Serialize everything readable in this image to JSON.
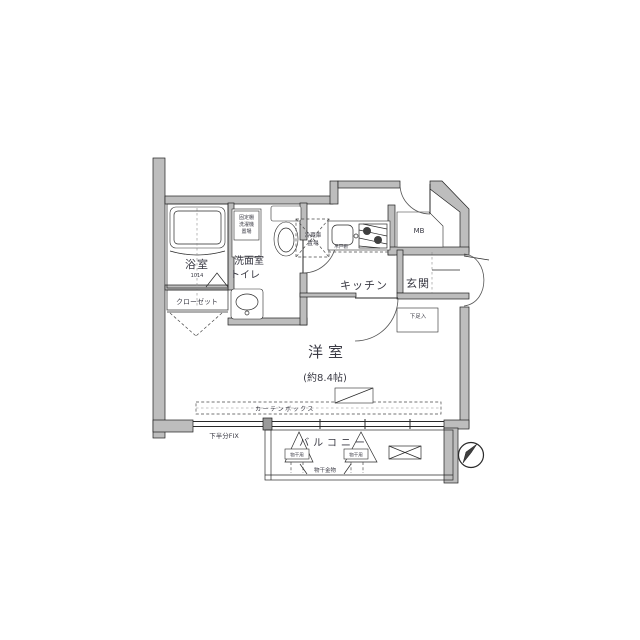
{
  "floorplan": {
    "bath": {
      "label": "浴室",
      "size": "1014"
    },
    "closet": {
      "label": "クローゼット"
    },
    "washroom": {
      "line1": "洗面室",
      "line2": "トイレ"
    },
    "washer_note": {
      "line1": "固定棚",
      "line2": "洗濯機",
      "line3": "置場"
    },
    "fridge_note": {
      "line1": "冷蔵庫",
      "line2": "置場"
    },
    "hanging_cupboard": {
      "label": "吊戸棚"
    },
    "kitchen": {
      "label": "キッチン"
    },
    "entrance": {
      "label": "玄関"
    },
    "meter_box": {
      "label": "MB"
    },
    "shoe_cabinet": {
      "label": "下足入"
    },
    "main_room": {
      "label": "洋室",
      "size": "(約8.4帖)"
    },
    "curtain_box": {
      "label": "カーテンボックス"
    },
    "fix_window": {
      "label": "下半分FIX"
    },
    "balcony": {
      "label": "バルコニー"
    },
    "laundry_hardware": {
      "label": "物干金物",
      "left_tag": "物干用",
      "right_tag": "物干用"
    },
    "colors": {
      "wall_gray": "#bdbdbd",
      "line": "#2a2a2a",
      "text": "#3a3a44"
    }
  }
}
